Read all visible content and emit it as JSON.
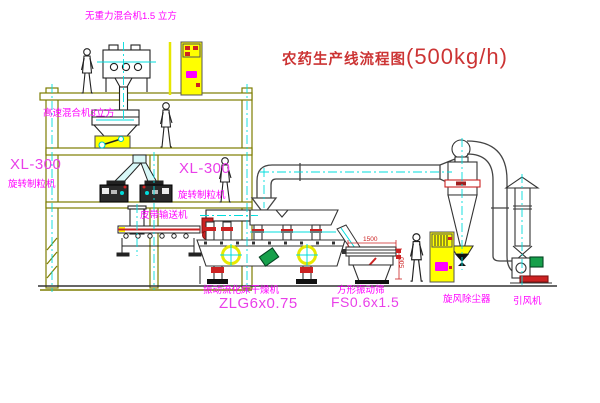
{
  "title": {
    "text": "农药生产线流程图",
    "capacity": "(500kg/h)"
  },
  "labels": {
    "zero_gravity_mixer": "无重力混合机1.5 立方",
    "high_speed_mixer": "高速混合机3立方",
    "xl300_left": "XL-300",
    "granulator_left": "旋转制粒机",
    "xl300_right": "XL-300",
    "granulator_right": "旋转制粒机",
    "belt_conveyor": "皮带输送机",
    "fluid_bed_dryer": "振动流化床干燥机",
    "fluid_bed_dryer_model": "ZLG6x0.75",
    "vibrating_screen": "方形振动筛",
    "vibrating_screen_model": "FS0.6x1.5",
    "cyclone": "旋风除尘器",
    "induced_draft_fan": "引风机",
    "dim_width": "1500",
    "dim_height": "500"
  },
  "colors": {
    "label_magenta": "#ff00ff",
    "title_red": "#cc3434",
    "structure_olive": "#7d7d00",
    "centerline_cyan": "#00dcdc",
    "cabinet_yellow": "#ffff00",
    "motor_green": "#17a04b",
    "mark_red": "#cc2222"
  }
}
